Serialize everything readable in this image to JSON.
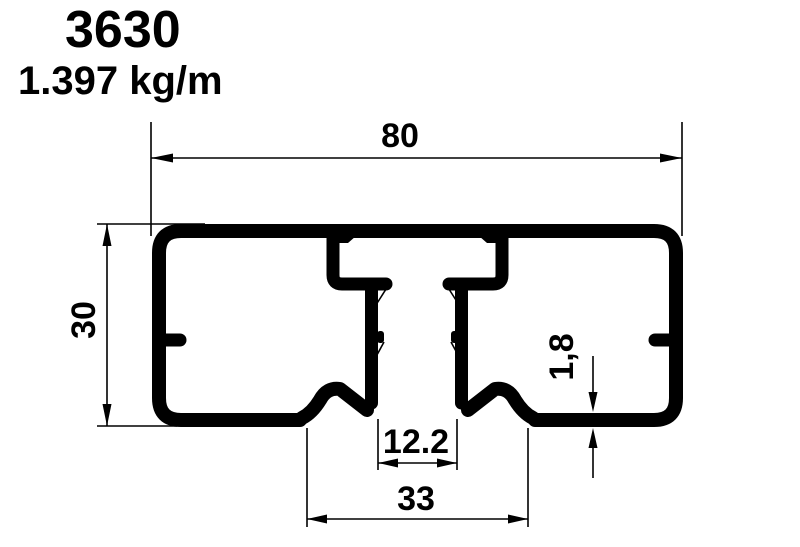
{
  "drawing": {
    "part_number": "3630",
    "weight": "1.397 kg/m",
    "dims": {
      "overall_width": "80",
      "overall_height": "30",
      "bottom_span": "33",
      "slot_opening": "12.2",
      "wall_thickness": "1,8"
    },
    "colors": {
      "ink": "#000000",
      "paper": "#ffffff"
    }
  }
}
